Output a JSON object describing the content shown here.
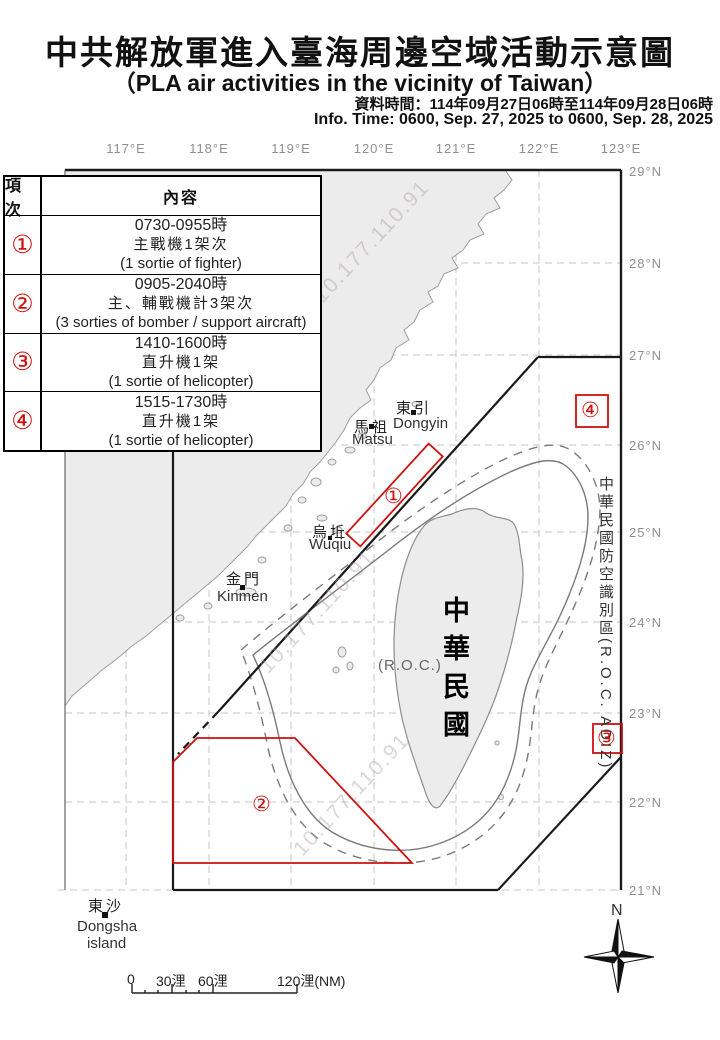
{
  "header": {
    "title_zh": "中共解放軍進入臺海周邊空域活動示意圖",
    "title_en": "（PLA air activities in the vicinity of Taiwan）",
    "info_zh": "資料時間：114年09月27日06時至114年09月28日06時",
    "info_en": "Info. Time: 0600, Sep. 27, 2025 to 0600, Sep. 28, 2025"
  },
  "table": {
    "col_item": "項次",
    "col_content": "內容",
    "rows": [
      {
        "num": "①",
        "time": "0730-0955時",
        "zh": "主戰機1架次",
        "en": "(1 sortie of fighter)"
      },
      {
        "num": "②",
        "time": "0905-2040時",
        "zh": "主、輔戰機計3架次",
        "en": "(3 sorties of bomber / support aircraft)"
      },
      {
        "num": "③",
        "time": "1410-1600時",
        "zh": "直升機1架",
        "en": "(1 sortie of helicopter)"
      },
      {
        "num": "④",
        "time": "1515-1730時",
        "zh": "直升機1架",
        "en": "(1 sortie of helicopter)"
      }
    ]
  },
  "map": {
    "lon_labels": [
      "117°E",
      "118°E",
      "119°E",
      "120°E",
      "121°E",
      "122°E",
      "123°E"
    ],
    "lat_labels": [
      "29°N",
      "28°N",
      "27°N",
      "26°N",
      "25°N",
      "24°N",
      "23°N",
      "22°N",
      "21°N"
    ],
    "markers": {
      "m1": "①",
      "m2": "②",
      "m3": "③",
      "m4": "④"
    },
    "places": {
      "dongyin_zh": "東引",
      "dongyin_en": "Dongyin",
      "matsu_zh": "馬祖",
      "matsu_en": "Matsu",
      "wuqiu_zh": "烏坵",
      "wuqiu_en": "Wuqiu",
      "kinmen_zh": "金門",
      "kinmen_en": "Kinmen",
      "dongsha_zh": "東沙",
      "dongsha_en1": "Dongsha",
      "dongsha_en2": "island",
      "roc_zh": "中華民國",
      "roc_en": "(R.O.C.)",
      "adiz": "中華民國防空識別區(R.O.C. ADIZ)"
    },
    "watermark": "10.177.110.91",
    "compass_n": "N",
    "scale": {
      "t0": "0",
      "t30": "30浬",
      "t60": "60浬",
      "t120": "120浬(NM)"
    }
  },
  "colors": {
    "accent_red": "#cc1111",
    "land_fill": "#ececec",
    "grid": "#c6c6c6",
    "boundary_black": "#1a1a1a"
  }
}
